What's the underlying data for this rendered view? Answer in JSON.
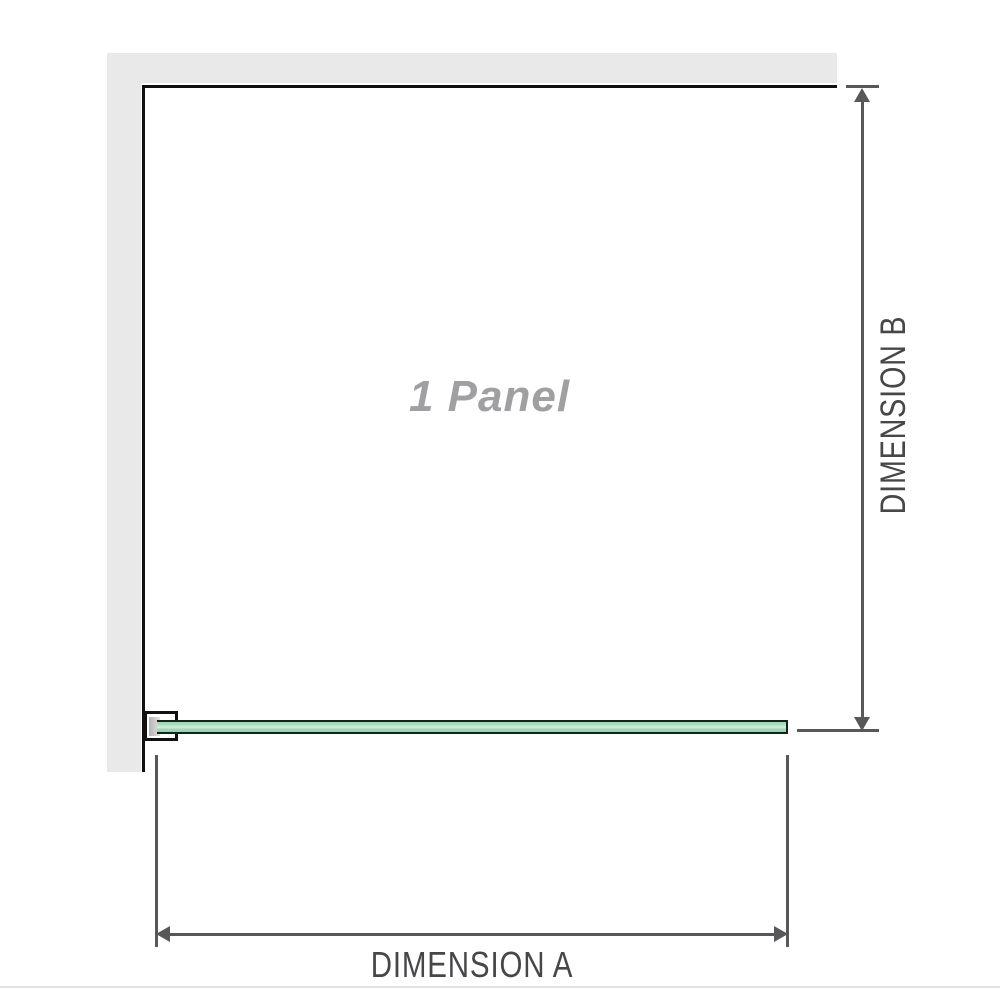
{
  "diagram": {
    "panel_label": "1 Panel",
    "dimension_a_label": "DIMENSION A",
    "dimension_b_label": "DIMENSION B"
  },
  "colors": {
    "background": "#ffffff",
    "wall_gray": "#e9e9e9",
    "outline_black": "#111111",
    "dimension_gray": "#58585a",
    "text_dark_gray": "#47474a",
    "label_gray": "#a0a0a2",
    "glass_green": "#9bd6b4",
    "glass_green_light": "#d7f0e2",
    "glass_border": "#13241b",
    "separator": "#e3e3e3"
  }
}
